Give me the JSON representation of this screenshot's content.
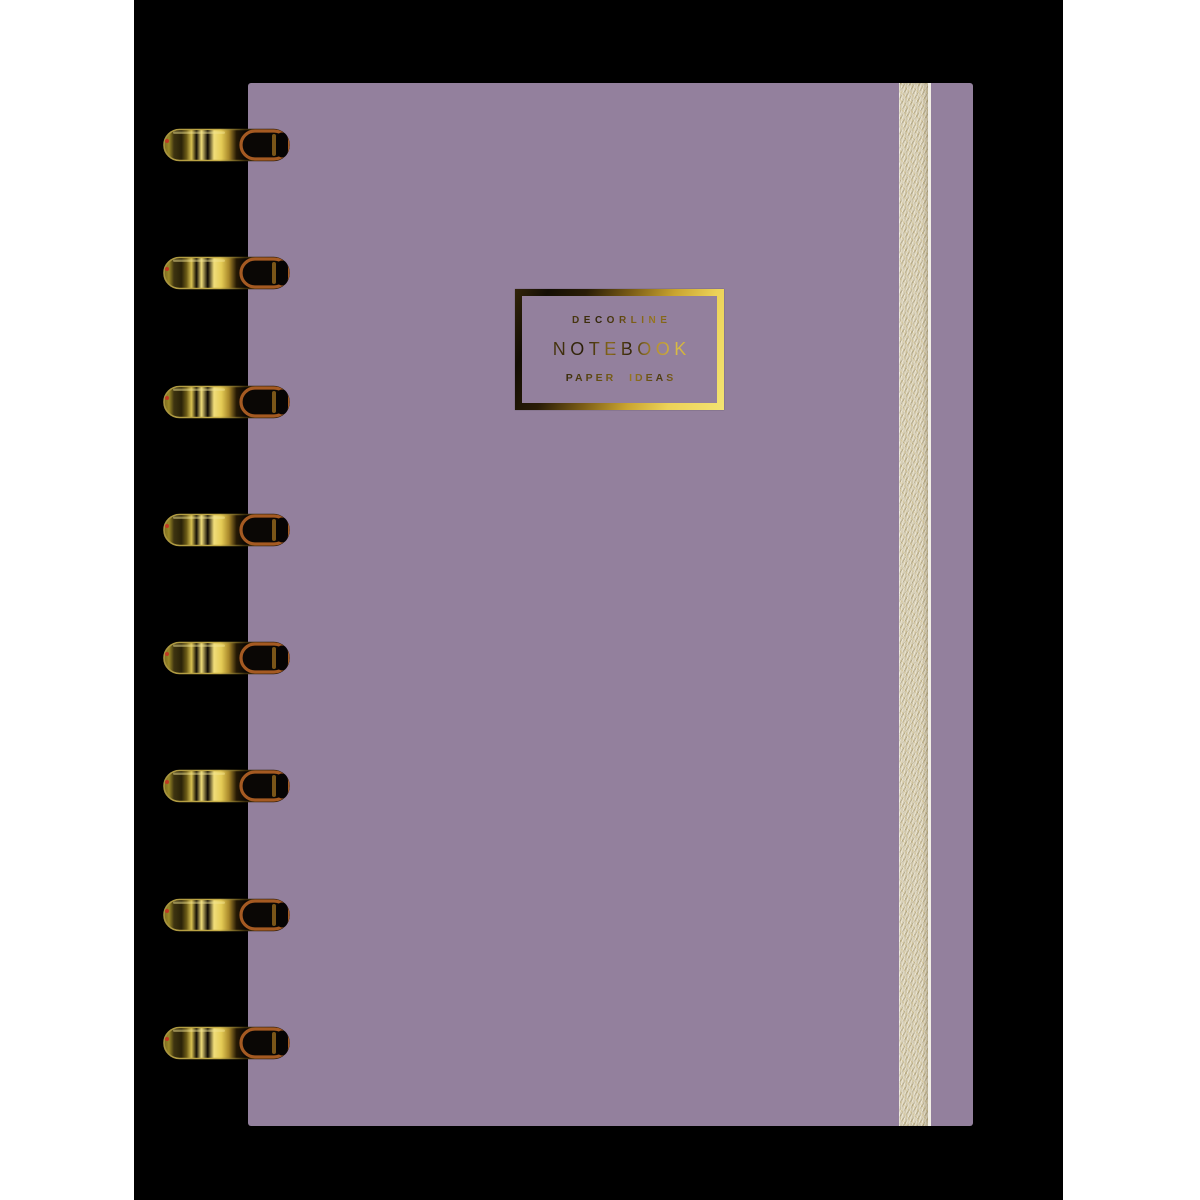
{
  "logo": {
    "top_line": "DECORLINE",
    "main_line": "NOTEBOOK",
    "bottom_line": "PAPER IDEAS"
  },
  "binding": {
    "ring_count": 8,
    "ring_material": "gold"
  },
  "colors": {
    "page": "#ffffff",
    "photo_bg": "#000000",
    "cover": "#93809d",
    "band": "#d8cfb5",
    "band_edge": "#f1eee4",
    "gold_bright": "#f0dd7a",
    "gold_dark": "#241a06",
    "copper": "#a55a22"
  }
}
